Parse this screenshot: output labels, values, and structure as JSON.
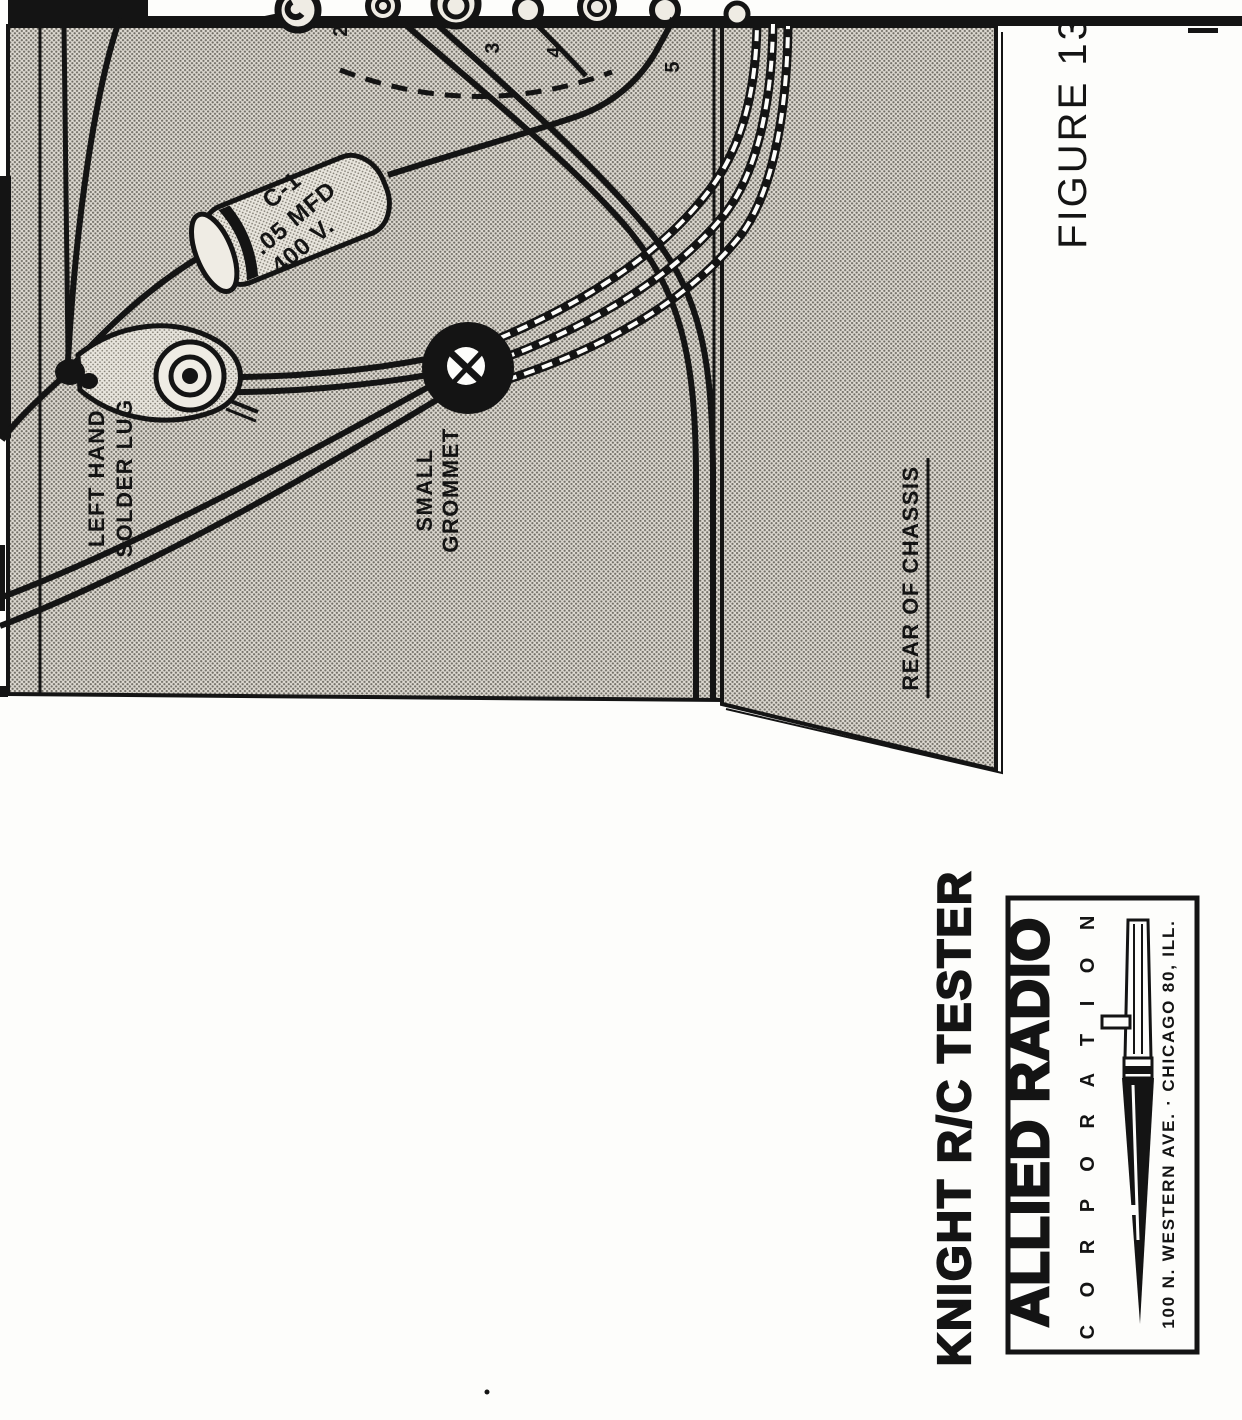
{
  "figure": {
    "caption": "FIGURE 13"
  },
  "diagram": {
    "terminal_numbers": {
      "t2": "2",
      "t3": "3",
      "t4": "4",
      "t5": "5"
    },
    "capacitor": {
      "line1": "C-1",
      "line2": ".05 MFD",
      "line3": "400 V."
    },
    "solder_lug_label": {
      "line1": "LEFT HAND",
      "line2": "SOLDER LUG"
    },
    "grommet_label": {
      "line1": "SMALL",
      "line2": "GROMMET"
    },
    "rear_of_chassis_label": "REAR OF CHASSIS"
  },
  "title_block": {
    "product": "KNIGHT R/C TESTER",
    "company": "ALLIED RADIO",
    "company_sub": "C O R P O R A T I O N",
    "address": "100 N. WESTERN AVE. · CHICAGO 80, ILL."
  },
  "colors": {
    "paper": "#fdfdfb",
    "ink": "#141414",
    "halftone_base": "#ddd9d1",
    "halftone_dot": "#716e66",
    "metal_light": "#efece4"
  }
}
